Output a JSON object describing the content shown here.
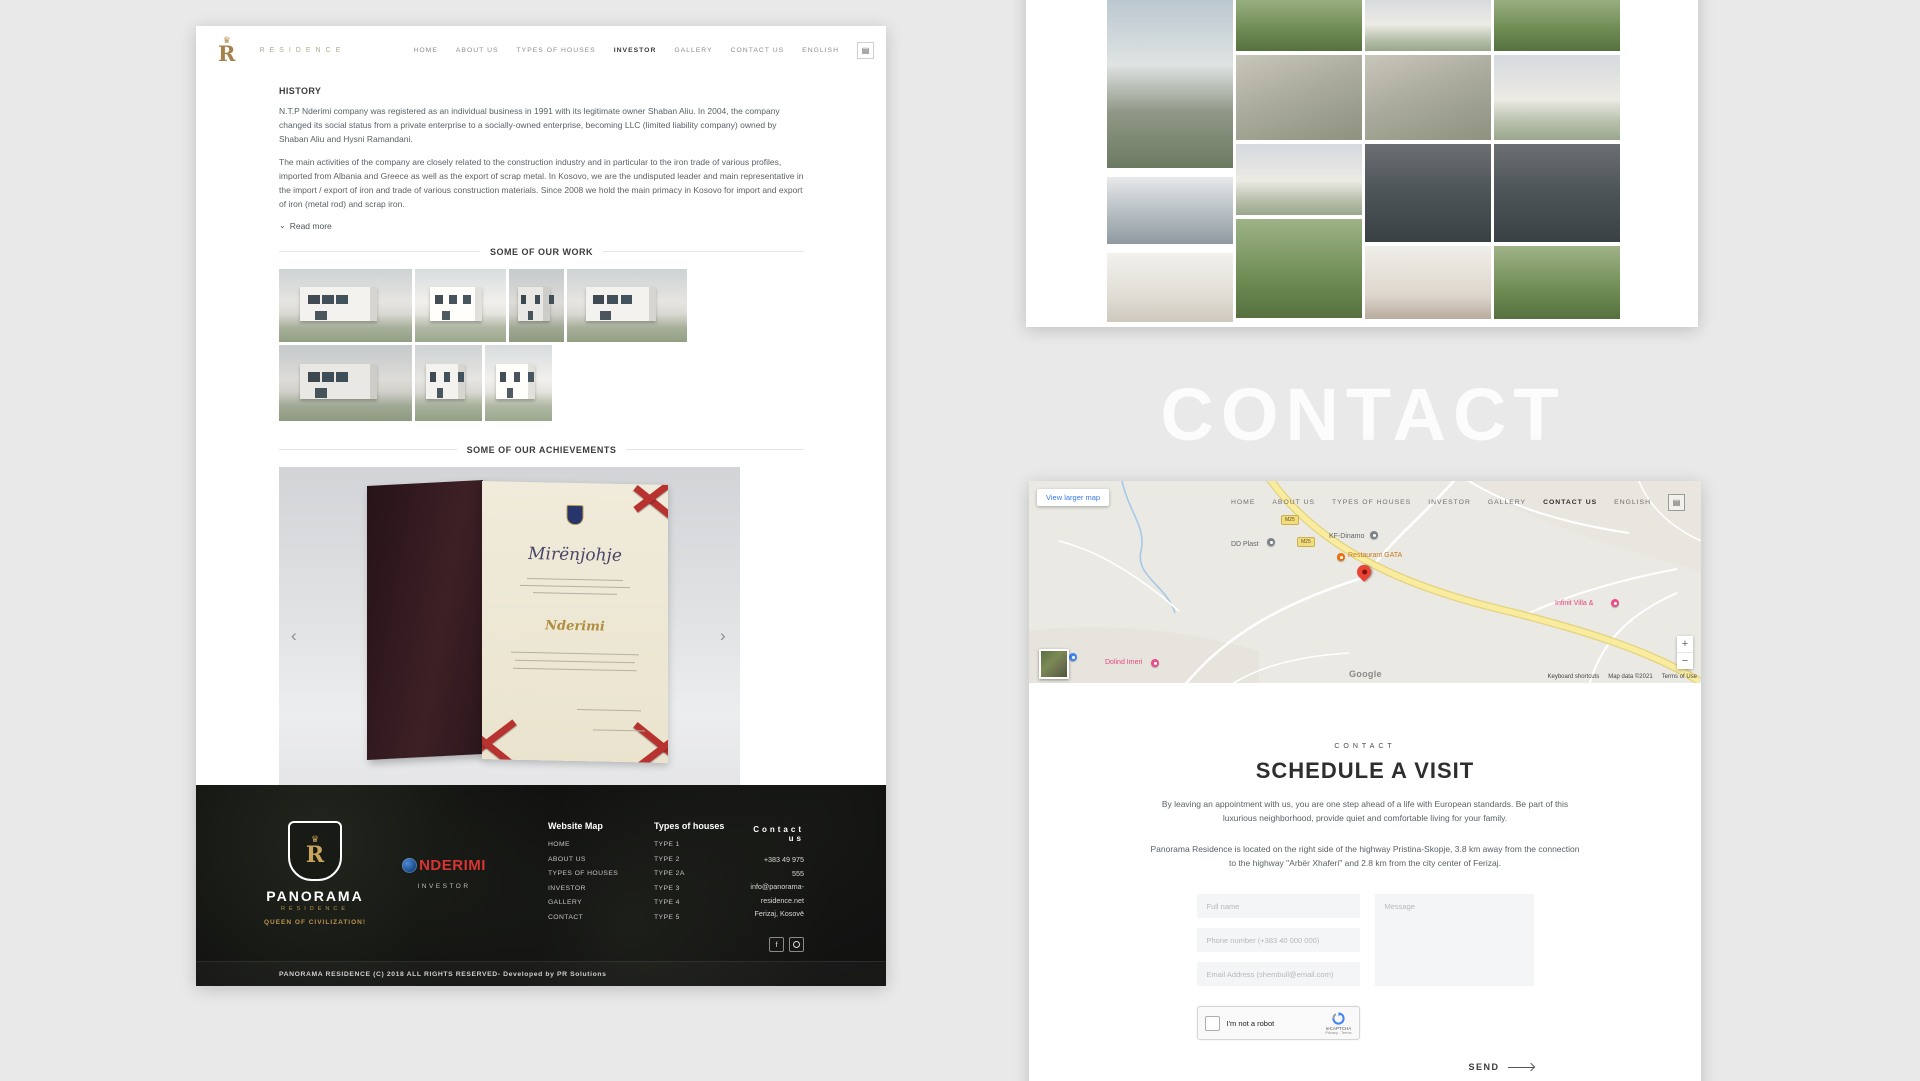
{
  "colors": {
    "gold": "#a5814b",
    "nderimi_red": "#d93434",
    "footer_bg": "#0d0d0d",
    "map_road_yellow": "#f7e9a2",
    "marker_red": "#ea4335",
    "recaptcha_blue": "#4285f4",
    "watermark_white": "#f7f7f7"
  },
  "nav": {
    "items": [
      "HOME",
      "ABOUT US",
      "TYPES OF HOUSES",
      "INVESTOR",
      "GALLERY",
      "CONTACT US",
      "ENGLISH"
    ]
  },
  "left_page": {
    "brand": {
      "letter": "R",
      "wordmark": "RESIDENCE"
    },
    "history": {
      "heading": "HISTORY",
      "p1": "N.T.P Nderimi company was registered as an individual business in 1991 with its legitimate owner Shaban Aliu. In 2004, the company changed its social status from a private enterprise to a socially-owned enterprise, becoming LLC (limited liability company) owned by Shaban Aliu and Hysni Ramandani.",
      "p2": "The main activities of the company are closely related to the construction industry and in particular to the iron trade of various profiles, imported from Albania and Greece as well as the export of scrap metal. In Kosovo, we are the undisputed leader and main representative in the import / export of iron and trade of various construction materials. Since 2008 we hold the main primacy in Kosovo for import and export of iron (metal rod) and scrap iron.",
      "read_more": "Read more",
      "chevron": "⌄"
    },
    "sections": {
      "work": "SOME OF OUR WORK",
      "achievements": "SOME OF OUR ACHIEVEMENTS"
    },
    "certificate": {
      "title": "Mirënjohje",
      "signature": "Nderimi",
      "prev": "‹",
      "next": "›"
    },
    "footer": {
      "panorama": {
        "name": "PANORAMA",
        "sub": "RESIDENCE",
        "tagline": "QUEEN OF CIVILIZATION!"
      },
      "nderimi": {
        "name": "NDERIMI",
        "label": "INVESTOR"
      },
      "website_map": {
        "heading": "Website Map",
        "links": [
          "HOME",
          "ABOUT US",
          "TYPES OF HOUSES",
          "INVESTOR",
          "GALLERY",
          "CONTACT"
        ]
      },
      "types": {
        "heading": "Types of houses",
        "links": [
          "TYPE 1",
          "TYPE 2",
          "TYPE 2A",
          "TYPE 3",
          "TYPE 4",
          "TYPE 5"
        ]
      },
      "contact": {
        "heading": "Contact us",
        "phone": "+383 49 975 555",
        "email": "info@panorama-residence.net",
        "location": "Ferizaj, Kosovë",
        "facebook": "f"
      },
      "copyright": "PANORAMA RESIDENCE (C) 2018 ALL RIGHTS RESERVED- Developed by PR Solutions"
    }
  },
  "watermark": "CONTACT",
  "map_page": {
    "map": {
      "view_larger": "View larger map",
      "shield1": "M25",
      "shield2": "M25",
      "poi": {
        "dd_plast": "DD Plast",
        "kf_dinamo": "KF-Dinamo",
        "restaurant": "Restaurant GATA",
        "infinit": "Infinit Villa &",
        "dolind": "Dolind Imeri"
      },
      "zoom_in": "+",
      "zoom_out": "−",
      "google": "Google",
      "attribution": {
        "shortcuts": "Keyboard shortcuts",
        "data": "Map data ©2021",
        "terms": "Terms of Use"
      }
    },
    "contact": {
      "kicker": "CONTACT",
      "title": "SCHEDULE A VISIT",
      "p1": "By leaving an appointment with us, you are one step ahead of a life with European standards. Be part of this luxurious neighborhood, provide quiet and comfortable living for your family.",
      "p2": "Panorama Residence is located on the right side of the highway Pristina-Skopje, 3.8 km away from the connection to the highway \"Arbër Xhaferi\" and 2.8 km from the city center of Ferizaj.",
      "form": {
        "full_name": "Full name",
        "phone": "Phone number (+383 40 000 000)",
        "email": "Email Address (shembull@email.com)",
        "message": "Message"
      },
      "recaptcha": {
        "label": "I'm not a robot",
        "brand": "reCAPTCHA",
        "privacy": "Privacy - Terms"
      },
      "send": "SEND"
    }
  }
}
